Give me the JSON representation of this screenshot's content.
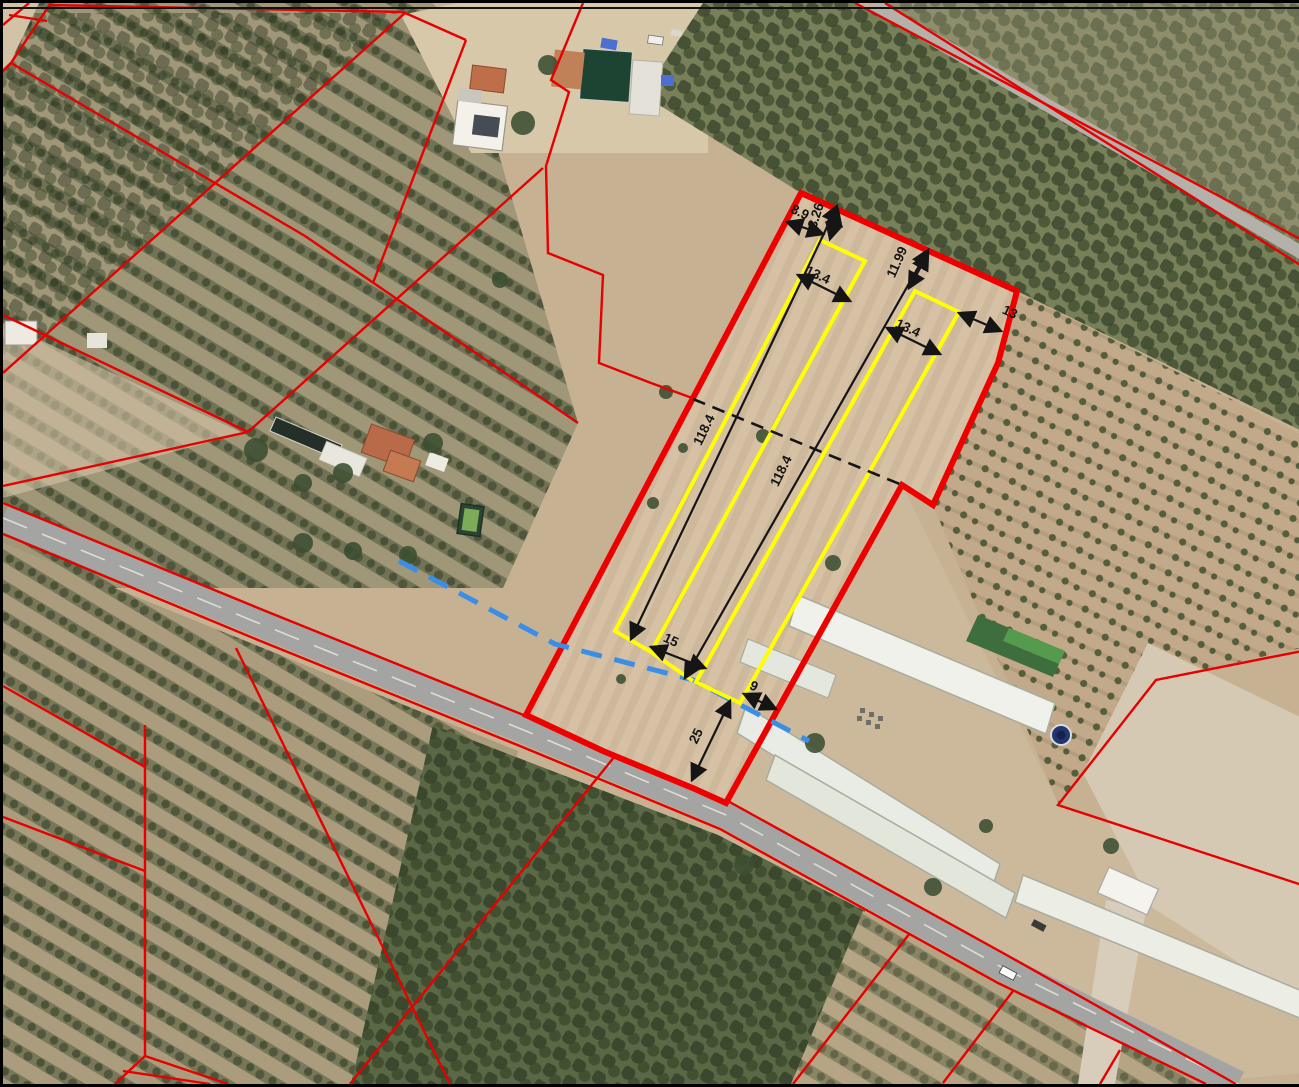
{
  "view": {
    "kind": "aerial cadastral survey plan",
    "width_px": 1299,
    "height_px": 1081
  },
  "colors": {
    "parcel_boundary": "#ee0000",
    "cadastral_line": "#e60000",
    "plot_outline": "#ffff00",
    "dimension": "#151515",
    "water_line": "#3a8ee6",
    "road": "#a4a4a2"
  },
  "dims": {
    "d1": "8.9",
    "d2": "3.26",
    "d3": "13.4",
    "d4": "11.99",
    "d5": "13.4",
    "d6": "13",
    "d7": "118.4",
    "d8": "118.4",
    "d9": "15",
    "d10": "9",
    "d11": "25"
  }
}
